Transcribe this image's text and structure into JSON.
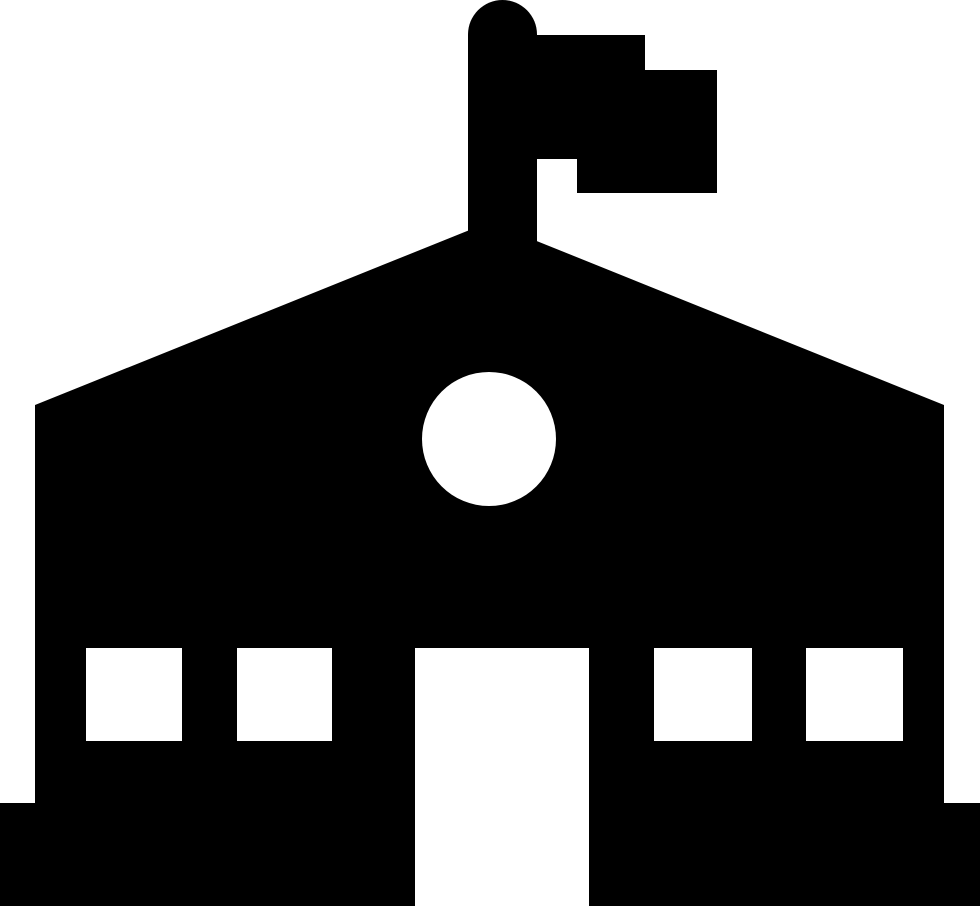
{
  "icon": {
    "name": "school-building-with-flag",
    "foreground_color": "#000000",
    "background_color": "#ffffff",
    "canvas": {
      "width": 980,
      "height": 910
    },
    "shapes": {
      "building": {
        "type": "polygon",
        "points": "35,405 489.5,222 944,405 944,803 35,803"
      },
      "flagpole": {
        "type": "path",
        "d": "M468,300 L468,34.5 A34.5,34.5 0 0 1 537,34.5 L537,300 Z"
      },
      "flag": {
        "type": "path",
        "d": "M537,35 L645,35 L645,70 L717,70 L717,193 L577,193 L577,159 L537,159 Z"
      },
      "base": {
        "type": "rect",
        "x": 0,
        "y": 803,
        "width": 980,
        "height": 103
      }
    },
    "cutouts": {
      "circle_window": {
        "type": "circle",
        "cx": 489,
        "cy": 439,
        "r": 67
      },
      "windows": [
        {
          "x": 86,
          "y": 648,
          "width": 96,
          "height": 93
        },
        {
          "x": 237,
          "y": 648,
          "width": 95,
          "height": 93
        },
        {
          "x": 654,
          "y": 648,
          "width": 98,
          "height": 93
        },
        {
          "x": 806,
          "y": 648,
          "width": 97,
          "height": 93
        }
      ],
      "door": {
        "x": 415,
        "y": 648,
        "width": 174,
        "height": 262
      }
    }
  }
}
